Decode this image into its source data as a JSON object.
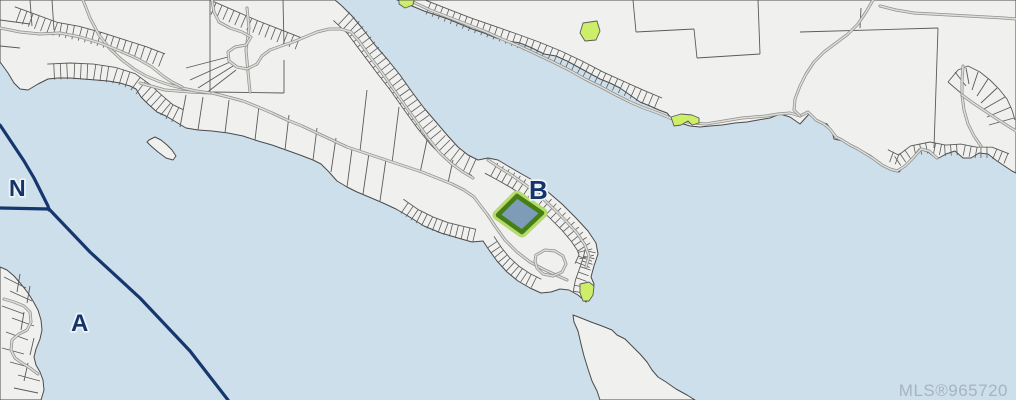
{
  "map": {
    "labels": [
      {
        "id": "zone-n",
        "text": "N",
        "x": 9,
        "y": 196,
        "size": 23
      },
      {
        "id": "zone-a",
        "text": "A",
        "x": 71,
        "y": 331,
        "size": 24
      },
      {
        "id": "zone-b",
        "text": "B",
        "x": 529,
        "y": 199,
        "size": 26
      }
    ],
    "watermark": {
      "text": "MLS®965720",
      "x": 1008,
      "y": 396,
      "size": 17
    },
    "highlighted_parcel": {
      "name": "subject-property",
      "zone": "B"
    },
    "colors": {
      "water": "#cddfeb",
      "land": "#f0f0ee",
      "coast": "#4a4a4a",
      "parcel_line": "#5a5a5a",
      "road_casing": "#8f8f8f",
      "road_fill": "#dedeclear",
      "road_inner": "#dedeD8",
      "boundary": "#16376d",
      "label": "#14356b",
      "label_halo": "#eef3f8",
      "highlight_fill": "#7e9cb8",
      "highlight_border": "#467f15",
      "highlight_halo": "#b7da6e",
      "green_parcel": "#cdee68",
      "watermark": "#a8b3be"
    }
  }
}
